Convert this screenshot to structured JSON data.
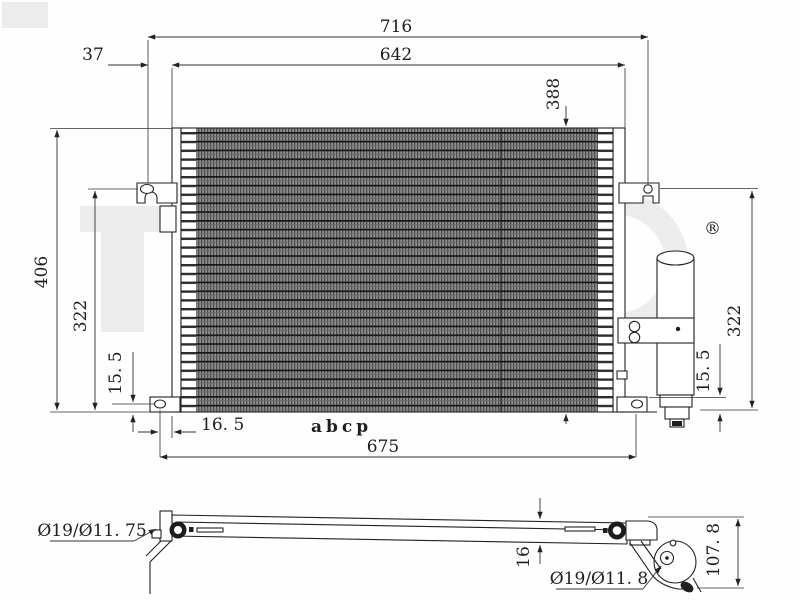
{
  "front_view": {
    "dim_716": "716",
    "dim_642": "642",
    "dim_37": "37",
    "dim_388": "388",
    "dim_406": "406",
    "dim_322_left": "322",
    "dim_15_5_left": "15. 5",
    "dim_16_5": "16. 5",
    "dim_675": "675",
    "dim_322_right": "322",
    "dim_15_5_right": "15. 5"
  },
  "side_view": {
    "port_left_label": "Ø19/Ø11. 75",
    "thickness_label": "16",
    "port_right_label": "Ø19/Ø11. 8",
    "height_label": "107. 8"
  },
  "watermark": {
    "registered_symbol": "®",
    "logo_text": "abcp"
  }
}
